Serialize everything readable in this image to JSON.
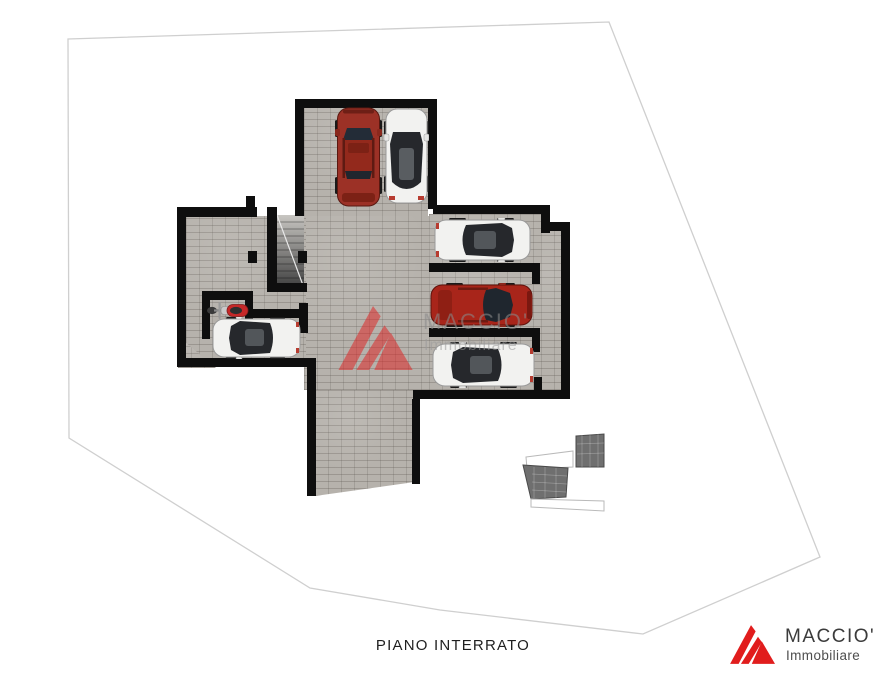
{
  "canvas": {
    "width": 880,
    "height": 680,
    "background": "#ffffff"
  },
  "caption": {
    "text": "PIANO INTERRATO"
  },
  "watermark": {
    "company": "MACCIO'",
    "tagline": "Immobiliare"
  },
  "logo": {
    "company": "MACCIO'",
    "tagline": "Immobiliare",
    "accent": "#e11d1d"
  },
  "floor_plan": {
    "label": "PIANO INTERRATO",
    "rooms": [
      {
        "name": "garage-hall"
      },
      {
        "name": "upper-garage-bay"
      },
      {
        "name": "left-corridor"
      },
      {
        "name": "internal-staircase"
      },
      {
        "name": "motorcycle-bay"
      },
      {
        "name": "left-car-bay"
      },
      {
        "name": "parking-bay-1"
      },
      {
        "name": "parking-bay-2"
      },
      {
        "name": "parking-bay-3"
      },
      {
        "name": "driveway-ramp"
      },
      {
        "name": "external-stairs"
      }
    ],
    "vehicles": [
      {
        "id": "suv-red-top",
        "type": "suv",
        "color": "#9c3126",
        "facing": "up"
      },
      {
        "id": "car-white-top",
        "type": "car",
        "color": "#f2f2f0",
        "facing": "up"
      },
      {
        "id": "car-white-bay-1",
        "type": "car",
        "color": "#f2f2f0",
        "facing": "right"
      },
      {
        "id": "car-red-bay-2",
        "type": "suv",
        "color": "#a8251a",
        "facing": "right"
      },
      {
        "id": "car-white-bay-3",
        "type": "car",
        "color": "#f2f2f0",
        "facing": "left"
      },
      {
        "id": "car-white-left",
        "type": "car",
        "color": "#f2f2f0",
        "facing": "left"
      },
      {
        "id": "scooter-red",
        "type": "motorcycle",
        "color": "#c62828",
        "facing": "left"
      }
    ]
  },
  "colors": {
    "paving": "#b6b2ac",
    "wall": "#0e0e0e",
    "boundary_line": "#cfcfcf"
  }
}
